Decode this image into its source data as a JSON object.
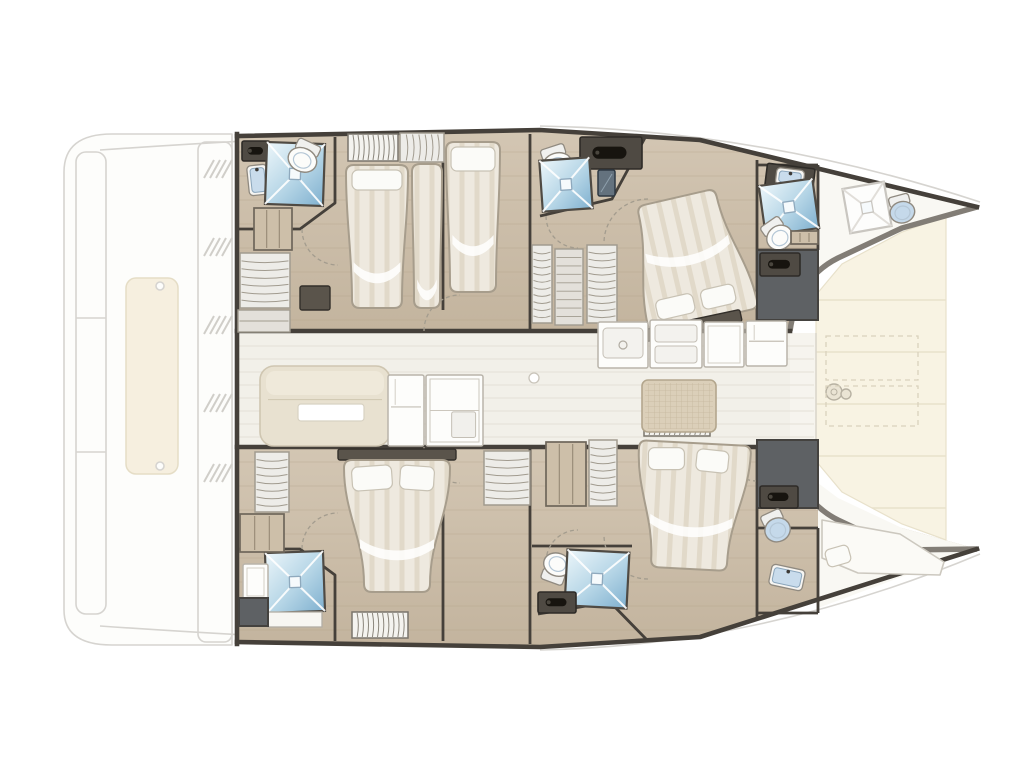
{
  "vessel": {
    "type": "catamaran-deck-plan",
    "orientation": "bow-right"
  },
  "legend": {
    "guest_cabins": 4,
    "double_beds": 4,
    "single_beds": 1,
    "bow_berths": 1,
    "showers": 6,
    "toilets": 6,
    "sinks": 4,
    "wardrobes": 8,
    "salon_sofa": 1,
    "galley_units": 5,
    "cockpit_table": 1
  },
  "rooms": [
    "port-aft-head",
    "port-aft-cabin",
    "port-single-cabin",
    "port-mid-head",
    "port-forward-cabin",
    "port-forward-head",
    "port-bow-crew-head",
    "salon-galley",
    "foredeck",
    "starboard-aft-head",
    "starboard-aft-cabin",
    "starboard-mid-head",
    "starboard-forward-cabin",
    "starboard-forward-head",
    "starboard-bow-berth"
  ],
  "palette": {
    "wall": "#45403a",
    "toerail": "#827d76",
    "wood": "#d3c6b3",
    "wood_dark": "#c3b49e",
    "plank": "#b3a288",
    "salon_floor": "#f2f0e9",
    "salon_line": "#e4e1d7",
    "deck_cream": "#f8f3e3",
    "deck_line": "#e8e1cb",
    "ghost": "#d6d4d0",
    "ghost_fill": "#fdfdfb",
    "sunpad": "#f6efdf",
    "sunpad_edge": "#e5ddc6",
    "dark_room": "#5e6164",
    "locker": "#4f4a43",
    "locker_edge": "#2e2b27",
    "handle": "#17140f",
    "shower_light": "#ecf6fa",
    "shower_mid": "#b5d5e6",
    "shower_deep": "#7fb0cf",
    "bed_base": "#eee9df",
    "bed_stripe": "#ddd4c3",
    "bed_edge": "#a79d8c",
    "pillow": "#fbfbf8",
    "pillow_edge": "#c8c2b4",
    "sofa": "#e8e1d0",
    "sofa_edge": "#cfc6b1",
    "fixture_white": "#fcfcfa",
    "fixture_edge": "#908a80",
    "basin_blue": "#c9dcec",
    "toilet_blue": "#c5d9ea",
    "grid_table": "#dbcfb9",
    "grid_line": "#c6b89e",
    "wardrobe_fill": "#edece8",
    "wardrobe_line": "#a19b8f",
    "shelf_wood": "#cdbfa9",
    "shelf_edge": "#6e665a",
    "drawer_fill": "#e3e0da",
    "arc": "#a39c8e",
    "bench_white": "#f7f6f2",
    "white_area": "#f9f8f3",
    "fwd_cockpit": "#f6f4ee"
  },
  "fixtures": [
    {
      "t": "counterDark",
      "n": "vanity-counter",
      "x": 242,
      "y": 141,
      "w": 28,
      "h": 20,
      "handle": true
    },
    {
      "t": "sink",
      "n": "sink",
      "x": 248,
      "y": 165,
      "w": 20,
      "h": 30,
      "rot": -6
    },
    {
      "t": "shower",
      "n": "shower",
      "x": 266,
      "y": 143,
      "w": 58,
      "h": 62,
      "rot": 2
    },
    {
      "t": "toilet",
      "n": "toilet",
      "x": 288,
      "y": 141,
      "w": 32,
      "h": 31,
      "rot": 25
    },
    {
      "t": "shelves",
      "n": "shelves",
      "x": 254,
      "y": 208,
      "w": 38,
      "h": 42
    },
    {
      "t": "wardrobe",
      "n": "wardrobe",
      "x": 240,
      "y": 253,
      "w": 50,
      "h": 55
    },
    {
      "t": "drawers",
      "n": "drawers",
      "x": 238,
      "y": 310,
      "w": 52,
      "h": 22
    },
    {
      "t": "blind",
      "n": "window-blind",
      "x": 348,
      "y": 134,
      "w": 50,
      "h": 27
    },
    {
      "t": "wardrobe",
      "n": "wardrobe",
      "x": 400,
      "y": 133,
      "w": 44,
      "h": 29
    },
    {
      "t": "bed",
      "n": "double-bed",
      "x": 346,
      "y": 165,
      "w": 62,
      "h": 143,
      "tt": 0,
      "tb": 6,
      "fold": 0.68,
      "pil": [
        [
          352,
          170,
          50,
          20,
          0
        ]
      ]
    },
    {
      "t": "bed",
      "n": "mattress",
      "x": 412,
      "y": 164,
      "w": 30,
      "h": 144,
      "tt": 0,
      "tb": 2,
      "fold": 0.8,
      "pil": []
    },
    {
      "t": "benchDark",
      "n": "step",
      "x": 300,
      "y": 286,
      "w": 30,
      "h": 24
    },
    {
      "t": "bed",
      "n": "single-bed",
      "x": 446,
      "y": 142,
      "w": 54,
      "h": 150,
      "tt": 0,
      "tb": 4,
      "fold": 0.62,
      "pil": [
        [
          451,
          147,
          44,
          24,
          0
        ]
      ]
    },
    {
      "t": "counterDark",
      "n": "deck-locker",
      "x": 580,
      "y": 137,
      "w": 62,
      "h": 32,
      "handle": true
    },
    {
      "t": "toilet",
      "n": "toilet",
      "x": 540,
      "y": 146,
      "w": 32,
      "h": 30,
      "rot": -18
    },
    {
      "t": "shower",
      "n": "shower",
      "x": 541,
      "y": 159,
      "w": 50,
      "h": 51,
      "rot": -4
    },
    {
      "t": "mirror",
      "n": "mirror-cabinet",
      "x": 598,
      "y": 170,
      "w": 17,
      "h": 26
    },
    {
      "t": "wardrobe",
      "n": "wardrobe",
      "x": 532,
      "y": 245,
      "w": 20,
      "h": 78
    },
    {
      "t": "drawers",
      "n": "drawers",
      "x": 555,
      "y": 249,
      "w": 28,
      "h": 76
    },
    {
      "t": "wardrobe",
      "n": "wardrobe",
      "x": 587,
      "y": 245,
      "w": 30,
      "h": 78
    },
    {
      "t": "bed",
      "n": "island-double-bed",
      "x": 634,
      "y": 196,
      "w": 112,
      "h": 126,
      "rot": -13,
      "tt": 16,
      "tb": 0,
      "fold": 0.38,
      "pil": [
        [
          646,
          292,
          38,
          20,
          0
        ],
        [
          692,
          292,
          34,
          20,
          0
        ]
      ]
    },
    {
      "t": "benchDark",
      "n": "headboard",
      "x": 640,
      "y": 320,
      "w": 102,
      "h": 12,
      "rot": -12
    },
    {
      "t": "counterDark",
      "n": "vanity-counter",
      "x": 766,
      "y": 166,
      "w": 48,
      "h": 23,
      "rot": 7
    },
    {
      "t": "sink",
      "n": "sink",
      "x": 776,
      "y": 169,
      "w": 28,
      "h": 17,
      "rot": 7
    },
    {
      "t": "shower",
      "n": "shower",
      "x": 762,
      "y": 182,
      "w": 54,
      "h": 50,
      "rot": -8
    },
    {
      "t": "toilet",
      "n": "toilet",
      "x": 763,
      "y": 219,
      "w": 29,
      "h": 31,
      "rot": -35
    },
    {
      "t": "shelves",
      "n": "shelf",
      "x": 791,
      "y": 231,
      "w": 27,
      "h": 13
    },
    {
      "t": "darkroom",
      "n": "technical-space",
      "x": 757,
      "y": 250,
      "w": 61,
      "h": 70
    },
    {
      "t": "lockerDark",
      "n": "locker",
      "x": 760,
      "y": 253,
      "w": 40,
      "h": 23
    },
    {
      "t": "shower",
      "n": "crew-shower",
      "x": 846,
      "y": 185,
      "w": 42,
      "h": 45,
      "rot": -10,
      "ghost": true
    },
    {
      "t": "toilet",
      "n": "crew-toilet",
      "x": 888,
      "y": 195,
      "w": 27,
      "h": 28,
      "rot": -15,
      "blue": true
    },
    {
      "t": "darkroom",
      "n": "technical-space",
      "x": 757,
      "y": 440,
      "w": 61,
      "h": 68
    },
    {
      "t": "lockerDark",
      "n": "locker",
      "x": 760,
      "y": 486,
      "w": 38,
      "h": 22
    },
    {
      "t": "toilet",
      "n": "toilet",
      "x": 762,
      "y": 511,
      "w": 28,
      "h": 31,
      "rot": -25,
      "blue": true
    },
    {
      "t": "sink",
      "n": "sink",
      "x": 770,
      "y": 567,
      "w": 34,
      "h": 21,
      "rot": 12
    },
    {
      "t": "berth",
      "n": "bow-berth",
      "pts": "M822,520 L900,534 L944,562 L940,575 L858,573 L822,558 Z"
    },
    {
      "t": "pillowFx",
      "n": "pillow",
      "x": 826,
      "y": 547,
      "w": 24,
      "h": 18,
      "rot": -16
    },
    {
      "t": "shower",
      "n": "shower",
      "x": 266,
      "y": 552,
      "w": 58,
      "h": 60,
      "rot": -2
    },
    {
      "t": "benchWhite",
      "n": "shower-bench",
      "x": 268,
      "y": 612,
      "w": 54,
      "h": 15
    },
    {
      "t": "galleyUnit",
      "n": "cabinet",
      "x": 243,
      "y": 564,
      "w": 25,
      "h": 36
    },
    {
      "t": "darkroom",
      "n": "technical-space",
      "x": 239,
      "y": 598,
      "w": 29,
      "h": 28
    },
    {
      "t": "wardrobe",
      "n": "wardrobe",
      "x": 255,
      "y": 452,
      "w": 34,
      "h": 60
    },
    {
      "t": "shelves",
      "n": "shelves",
      "x": 240,
      "y": 514,
      "w": 44,
      "h": 38
    },
    {
      "t": "benchDark",
      "n": "headboard",
      "x": 338,
      "y": 449,
      "w": 118,
      "h": 11
    },
    {
      "t": "bed",
      "n": "island-double-bed",
      "x": 344,
      "y": 460,
      "w": 106,
      "h": 132,
      "tt": 0,
      "tb": 20,
      "fold": 0.6,
      "pil": [
        [
          352,
          466,
          40,
          24,
          -4
        ],
        [
          400,
          466,
          34,
          24,
          4
        ]
      ]
    },
    {
      "t": "wardrobe",
      "n": "wardrobe",
      "x": 484,
      "y": 451,
      "w": 46,
      "h": 54
    },
    {
      "t": "blind",
      "n": "window-blind",
      "x": 352,
      "y": 612,
      "w": 56,
      "h": 26
    },
    {
      "t": "toilet",
      "n": "toilet",
      "x": 541,
      "y": 553,
      "w": 30,
      "h": 30,
      "rot": 200
    },
    {
      "t": "shower",
      "n": "shower",
      "x": 566,
      "y": 551,
      "w": 62,
      "h": 56,
      "rot": 3
    },
    {
      "t": "lockerDark",
      "n": "locker",
      "x": 538,
      "y": 592,
      "w": 38,
      "h": 21
    },
    {
      "t": "shelves",
      "n": "shelves",
      "x": 546,
      "y": 442,
      "w": 40,
      "h": 64
    },
    {
      "t": "wardrobe",
      "n": "wardrobe",
      "x": 589,
      "y": 440,
      "w": 28,
      "h": 66
    },
    {
      "t": "blind",
      "n": "window-blind",
      "x": 644,
      "y": 420,
      "w": 66,
      "h": 16
    },
    {
      "t": "bed",
      "n": "island-double-bed",
      "x": 636,
      "y": 443,
      "w": 112,
      "h": 126,
      "rot": 3,
      "tt": 0,
      "tb": 18,
      "fold": 0.58,
      "pil": [
        [
          646,
          449,
          36,
          22,
          -3
        ],
        [
          694,
          449,
          32,
          22,
          3
        ]
      ]
    },
    {
      "t": "sofa",
      "n": "salon-sofa",
      "x": 260,
      "y": 366,
      "w": 130,
      "h": 80
    },
    {
      "t": "tableWhite",
      "n": "salon-table",
      "x": 298,
      "y": 404,
      "w": 66,
      "h": 17
    },
    {
      "t": "galleyUnit",
      "n": "galley-cabinet",
      "x": 388,
      "y": 375,
      "w": 36,
      "h": 71,
      "opt": "fridge"
    },
    {
      "t": "galleyUnit",
      "n": "galley-cabinet",
      "x": 426,
      "y": 375,
      "w": 57,
      "h": 71,
      "opt": "shelves"
    },
    {
      "t": "circleFx",
      "n": "ceiling-light",
      "x": 534,
      "y": 378,
      "r": 5
    },
    {
      "t": "galleyUnit",
      "n": "galley-sink-unit",
      "x": 598,
      "y": 322,
      "w": 50,
      "h": 46,
      "opt": "sink"
    },
    {
      "t": "galleyUnit",
      "n": "galley-stove",
      "x": 650,
      "y": 320,
      "w": 52,
      "h": 48,
      "opt": "stove"
    },
    {
      "t": "galleyUnit",
      "n": "galley-counter",
      "x": 704,
      "y": 322,
      "w": 40,
      "h": 45
    },
    {
      "t": "galleyUnit",
      "n": "fridge",
      "x": 746,
      "y": 321,
      "w": 41,
      "h": 45,
      "opt": "fridge"
    },
    {
      "t": "gridTable",
      "n": "cockpit-table",
      "x": 642,
      "y": 380,
      "w": 74,
      "h": 52
    },
    {
      "t": "windlass",
      "n": "windlass",
      "x": 834,
      "y": 392
    },
    {
      "t": "dashedRect",
      "n": "deck-hatch",
      "x": 826,
      "y": 336,
      "w": 92,
      "h": 44
    },
    {
      "t": "dashedRect",
      "n": "deck-hatch",
      "x": 826,
      "y": 386,
      "w": 92,
      "h": 40
    }
  ],
  "door_arcs": [
    "M302,229 A36,36 0 0 0 338,265",
    "M424,331 A36,36 0 0 1 460,295",
    "M546,216 A32,32 0 0 0 578,248",
    "M648,199 A44,44 0 0 0 604,243",
    "M757,297 A32,32 0 0 0 725,329",
    "M302,549 A36,36 0 0 1 338,513",
    "M424,447 A36,36 0 0 0 460,483",
    "M546,562 A32,32 0 0 1 578,530",
    "M648,579 A44,44 0 0 1 604,535",
    "M757,481 A32,32 0 0 1 725,449"
  ]
}
